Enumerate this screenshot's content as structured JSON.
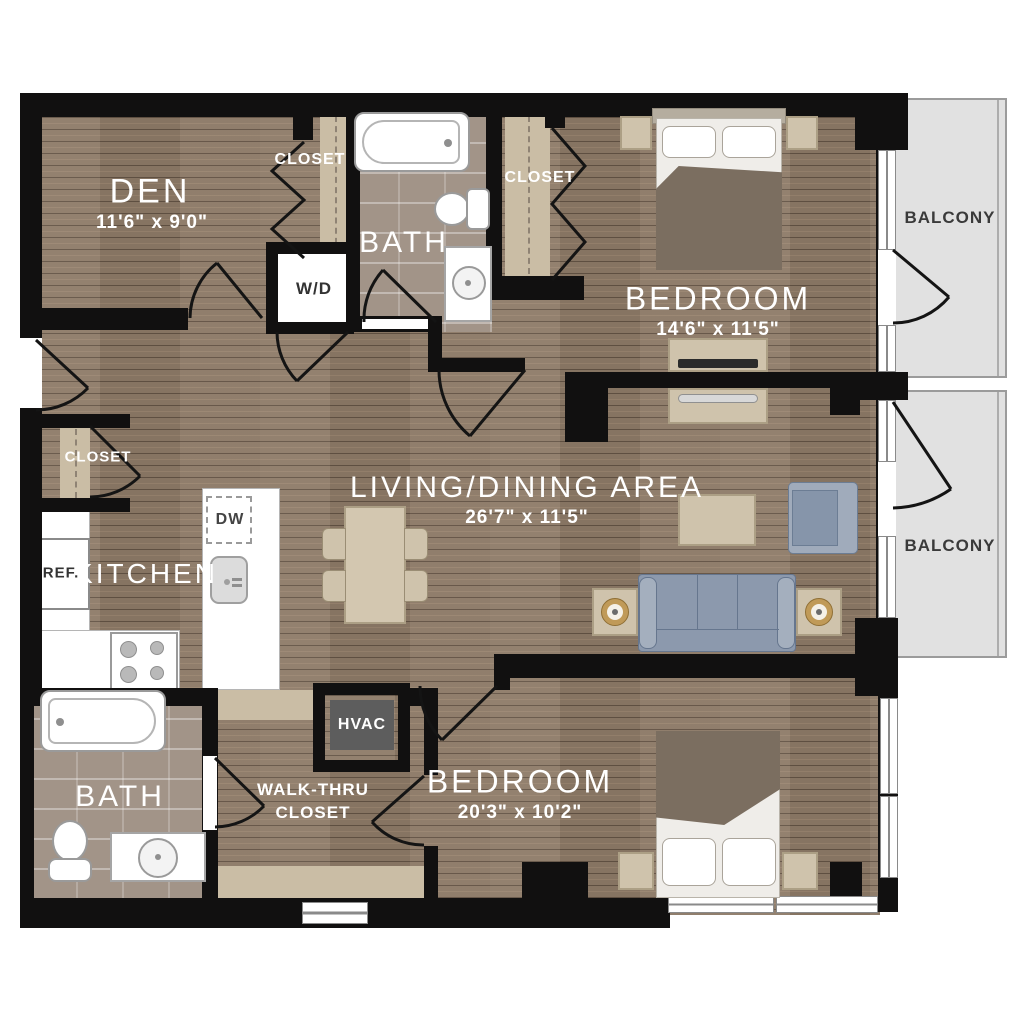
{
  "labels": {
    "den": {
      "name": "DEN",
      "dims": "11'6\" x 9'0\""
    },
    "bath_upper": {
      "name": "BATH"
    },
    "bath_lower": {
      "name": "BATH"
    },
    "closet_den": {
      "name": "CLOSET"
    },
    "closet_bedroom": {
      "name": "CLOSET"
    },
    "closet_entry": {
      "name": "CLOSET"
    },
    "bedroom_upper": {
      "name": "BEDROOM",
      "dims": "14'6\" x 11'5\""
    },
    "bedroom_lower": {
      "name": "BEDROOM",
      "dims": "20'3\" x 10'2\""
    },
    "living": {
      "name": "LIVING/DINING AREA",
      "dims": "26'7\" x 11'5\""
    },
    "kitchen": {
      "name": "KITCHEN"
    },
    "balcony_upper": {
      "name": "BALCONY"
    },
    "balcony_lower": {
      "name": "BALCONY"
    },
    "laundry": {
      "name": "W/D"
    },
    "dishwasher": {
      "name": "DW"
    },
    "refrigerator": {
      "name": "REF."
    },
    "hvac": {
      "name": "HVAC"
    },
    "walkthru": {
      "line1": "WALK-THRU",
      "line2": "CLOSET"
    }
  },
  "colors": {
    "wall": "#111010",
    "wood_floor": "#8d7a67",
    "bath_tile": "#a29488",
    "closet_floor": "#cabda5",
    "balcony": "#e1e1e1",
    "upholstery_blue": "#8c99ad",
    "furniture_beige": "#cfc3ac",
    "bedding_taupe": "#7b6e60"
  }
}
